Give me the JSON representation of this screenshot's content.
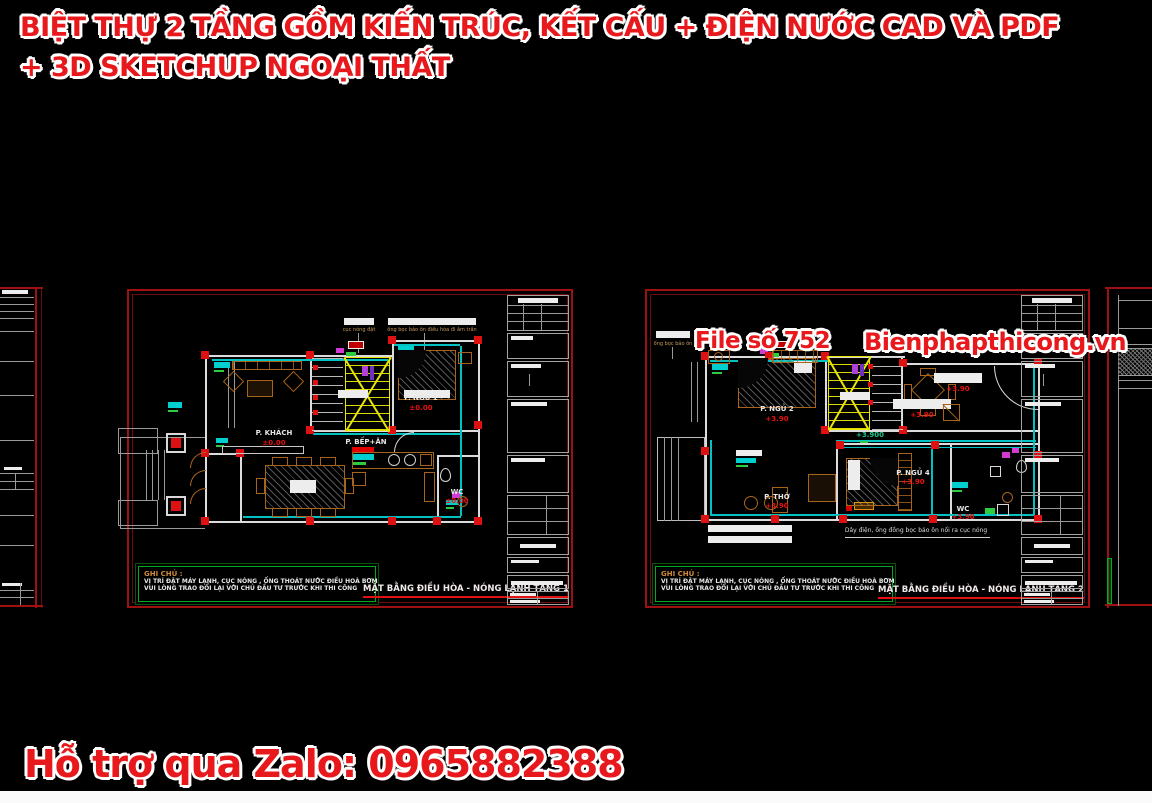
{
  "header": {
    "line1": "BIỆT THỰ 2 TẦNG GỒM KIẾN TRÚC, KẾT CẤU + ĐIỆN NƯỚC CAD VÀ PDF",
    "line2": "+ 3D SKETCHUP NGOẠI THẤT"
  },
  "watermark": {
    "file_label": "File số 752",
    "site_label": "Bienphapthicong.vn"
  },
  "footer": {
    "support_label": "Hỗ trợ qua Zalo: 0965882388"
  },
  "colors": {
    "accent_red": "#e8191d",
    "pipe_cyan": "#00c2c2",
    "stair_yellow": "#e6e600",
    "furniture_brown": "#a9641c",
    "note_green": "#00aa22",
    "sheet_border_red": "#9e1111"
  },
  "sheet1": {
    "annotation1": "cục nóng đặt",
    "annotation2": "ống bọc bảo ôn điều hòa đi âm trần",
    "rooms": {
      "khach": {
        "name": "P. KHÁCH",
        "level": "±0.00"
      },
      "bep": {
        "name": "P. BẾP+ĂN"
      },
      "ngu1": {
        "name": "P. NGỦ 1",
        "level": "±0.00"
      },
      "wc": {
        "name": "WC",
        "level": "±0.00"
      }
    },
    "note": {
      "heading": "GHI CHÚ :",
      "line1": "VỊ TRÍ ĐẶT MÁY LẠNH, CỤC NÓNG , ỐNG THOÁT NƯỚC ĐIỀU HOÀ BƠM",
      "line2": "VUI LÒNG TRAO ĐỔI LẠI VỚI CHỦ ĐẦU TƯ TRƯỚC KHI THI CÔNG"
    },
    "title": "MẶT BẰNG ĐIỀU HÒA - NÓNG LẠNH TẦNG 1"
  },
  "sheet2": {
    "annotation1": "ống bọc bảo ôn",
    "cable_note": "Dây điện, ống đồng bọc bảo ôn nối ra cục nóng",
    "elevation": "+3.900",
    "rooms": {
      "ngu2": {
        "name": "P. NGỦ 2",
        "level": "+3.90"
      },
      "tho": {
        "name": "P. THỜ",
        "level": "+3.90"
      },
      "ngu4": {
        "name": "P. NGỦ 4",
        "level": "+3.90"
      },
      "wc": {
        "name": "WC",
        "level": "+3.90"
      },
      "center": {
        "level": "+3.90"
      },
      "right": {
        "level": "+3.90"
      }
    },
    "note": {
      "heading": "GHI CHÚ :",
      "line1": "VỊ TRÍ ĐẶT MÁY LẠNH, CỤC NÓNG , ỐNG THOÁT NƯỚC ĐIỀU HOÀ BƠM",
      "line2": "VUI LÒNG TRAO ĐỔI LẠI VỚI CHỦ ĐẦU TƯ TRƯỚC KHI THI CÔNG"
    },
    "title": "MẶT BẰNG ĐIỀU HÒA - NÓNG LẠNH TẦNG 2"
  }
}
